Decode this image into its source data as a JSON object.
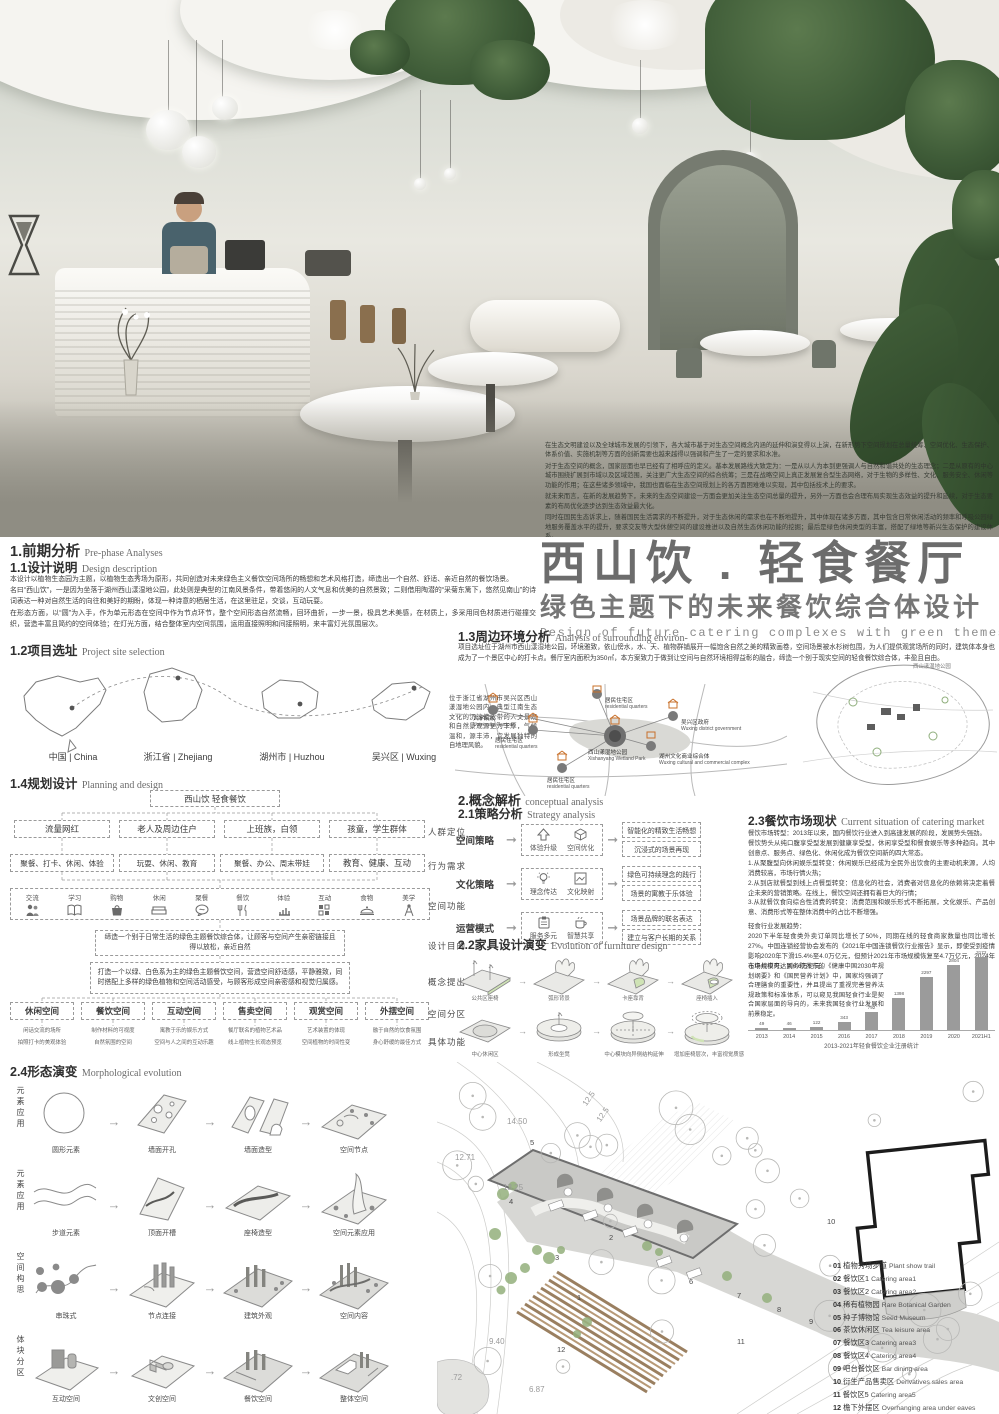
{
  "poster": {
    "title_cn": "西山饮 . 轻食餐厅",
    "subtitle_cn": "绿色主题下的未来餐饮综合体设计",
    "subtitle_en": "Design of future catering complexes with green themes"
  },
  "overlay": {
    "p1": "在生态文明建设以及全球城市发展的引领下，各大城市基于对生态空间概念内涵的延伸和演变得以上演，在新形势下空间规划在总量统筹、空间优化、生态保护、体系价值、实施机制等方面的创新需要也越来越得以强调和产生了一定的要求和水准。",
    "p2": "对于生态空间的概念，国家层面也早已经有了相呼应的定义。基本发展路线大致定为：一是从以人为本到更强调人与自然和谐共处的生态理念；二是从原有的中心城市围绕扩展到市域以及区域范围，关注更广大生态空间的综合统筹；三是在战略空间上真正发展复合型生态网络，对于生物的多样性、文化、服务安全、休闲等功能的作用；在这些诸多领域中，我国也面临在生态空间规划上的各方面困难难以实现，其中包括技术上的要求。",
    "p3": "就未来而言，在新的发展趋势下，未来的生态空间建设一方面会更加关注生态空间总量的提升，另外一方面也会合理布局实现生态效益的提升和延续，对于生态要素的布局优化逐步达到生态效益最大化。",
    "p4": "同时在国民生态诉求上，随着国民生活需求的不断提升，对于生态休闲的需求也在不断地提升，其中体现在诸多方面，其中包含日常休闲活动的频率和呼吸公园绿地服务覆盖水平的提升，要求交友等大型休憩空间的建设推进以及自然生态休闲功能的挖掘；最后是绿色休闲类型的丰富，搭配了绿地等新兴生态保护的建设体系。",
    "p5": "因此“未来化的绿色主义”也绝不再是一句空谈，而是真是极大众所需求的国家战略的未来发展趋势。"
  },
  "sec1": {
    "h_cn": "1.前期分析",
    "h_en": "Pre-phase Analyses",
    "s11_cn": "1.1设计说明",
    "s11_en": "Design description",
    "p1": "本设计以植物生态园为主题，以植物生态秀场为原形，共同创造对未来绿色主义餐饮空间场所的畅想和艺术风格打造，缔造出一个自然、舒适、亲近自然的餐饮场景。",
    "p2": "名曰“西山饮”，一是因为坐落于湖州西山漾湿地公园，此处则是典型的江南风景条件，带着悠闲的人文气息和优美的自然景致；二则借用陶潜的“采菊东篱下，悠然见南山”的诗词表达一种对自然生活的向往和美好的期盼，体现一种诗意的栖居生活，在这里驻足，交谈，互动玩耍。",
    "p3": "在形态方面，以“圆”为入手，作为单元形态在空间中作为节点环节，整个空间形态自然流畅，回环曲折，一步一景，极具艺术美感，在材质上，多采用同色材质进行碰撞交织，营造丰富且简约的空间体验；在灯光方面，结合整体室内空间氛围，运用直接照明和间接照明，来丰富灯光氛围层次。",
    "s12_cn": "1.2项目选址",
    "s12_en": "Project site selection",
    "maps": [
      "中国 | China",
      "浙江省 | Zhejiang",
      "湖州市 | Huzhou",
      "吴兴区 | Wuxing"
    ],
    "site_note": "位于浙江省湖州市吴兴区西山漾湿地公园内，典型江南生态文化的沉淀使此带的人文景观和自然景观源更为丰厚，气候温和，源丰沛，宜发展独特的自地理风貌。"
  },
  "sec13": {
    "h_cn": "1.3周边环境分析",
    "h_en": "Analysis of surrounding environ-",
    "p": "项目选址位于湖州市西山漾湿地公园，环境雅致，依山傍水，水、天、植物群铺展开一幅饱含自然之美的精致画卷，空间场景被水杉树包围，为人们提供观赏场所的同时，建筑体本身也成为了一个景区中心的打卡点。餐厅室内面积为350㎡，本方案致力于做到让空间与自然环境相得益彰的融合，缔造一个别于现实空间的轻食餐饮综合体，丰盈且自由。",
    "nodes": [
      {
        "cn": "大学院校",
        "en": "University Campus"
      },
      {
        "cn": "居民住宅区",
        "en": "residential quarters"
      },
      {
        "cn": "吴兴区政府",
        "en": "Wuxing district government"
      },
      {
        "cn": "居民住宅区",
        "en": "residential quarters"
      },
      {
        "cn": "西山漾湿地公园",
        "en": "Xishanyang Wetland Park"
      },
      {
        "cn": "湖州文化商业综合体",
        "en": "Wuxing cultural and commercial complex"
      },
      {
        "cn": "居民住宅区",
        "en": "residential quarters"
      }
    ],
    "aerial_label": "西山漾湿地公园"
  },
  "sec14": {
    "h_cn": "1.4规划设计",
    "h_en": "Planning and design",
    "root": "西山饮 轻食餐饮",
    "groups": [
      "流量网红",
      "老人及周边住户",
      "上班族，白领",
      "孩童，学生群体"
    ],
    "behaviors": [
      "聚餐、打卡、休闲、体验",
      "玩耍、休闲、教育",
      "聚餐、办公、周末带娃",
      "教育、健康、互动"
    ],
    "functions": [
      "交流",
      "学习",
      "购物",
      "休闲",
      "聚餐",
      "餐饮",
      "体验",
      "互动",
      "食物",
      "美学"
    ],
    "purpose": "缔造一个别于日常生活的绿色主题餐饮综合体，让顾客与空间产生亲密链接且得以放松，亲近自然",
    "concept": "打造一个以绿、白色系为主的绿色主题餐饮空间，营造空间舒适感，平静雅致，同时搭配上多样的绿色植物和空间活动感受，与顾客形成空间亲密感和视觉归属感。",
    "zones": [
      "休闲空间",
      "餐饮空间",
      "互动空间",
      "售卖空间",
      "观赏空间",
      "外摆空间"
    ],
    "zone_details": [
      [
        "闲话交流的场所",
        "拍照打卡的美观体验"
      ],
      [
        "制作材料的可视度",
        "自然氛围的空间"
      ],
      [
        "寓教于乐的娱乐方式",
        "空间与人之间的互动乐趣"
      ],
      [
        "餐厅联名的植物艺术品",
        "线上植物生长观态预览"
      ],
      [
        "艺术装置的体现",
        "空间植物的时间性变"
      ],
      [
        "融于自然的饮食氛围",
        "身心舒缓的最佳方式"
      ]
    ],
    "side_labels": [
      "人群定位",
      "行为需求",
      "空间功能",
      "设计目的",
      "概念提出",
      "空间分区",
      "具体功能"
    ]
  },
  "sec2": {
    "h_cn": "2.概念解析",
    "h_en": "conceptual analysis",
    "s21_cn": "2.1策略分析",
    "s21_en": "Strategy analysis",
    "rows": [
      {
        "label": "空间策略",
        "mid1": "体验升级",
        "mid2": "空间优化",
        "out1": "智能化的精致生活畅想",
        "out2": "沉浸式的场景再现"
      },
      {
        "label": "文化策略",
        "mid1": "理念传达",
        "mid2": "文化映射",
        "out1": "绿色可持续理念的践行",
        "out2": "场景的寓教于乐体验"
      },
      {
        "label": "运营模式",
        "mid1": "服务多元",
        "mid2": "智慧共享",
        "out1": "场景品牌的联名表达",
        "out2": "建立与客户长期的关系"
      }
    ],
    "s22_cn": "2.2家具设计演变",
    "s22_en": "Evolution of furniture design",
    "row1": [
      "公共区座椅",
      "弧形背景",
      "卡座靠背",
      "座椅插入"
    ],
    "row2": [
      "中心休闲区",
      "形成坐凳",
      "中心模块向异侧结构延伸",
      "增加座椅层次，丰富视觉质感"
    ],
    "s23_cn": "2.3餐饮市场现状",
    "s23_en": "Current situation of catering market",
    "p1": "餐饮市场转型：2013年以来，国内餐饮行业进入到高速发展的阶段，发展势头强劲。",
    "p2": "餐饮势头从纯口腹享受型发展到健康享受型，休闲享受型和餐食娱乐等多种趋向。其中创意点、服务点、绿色化、休闲化成为餐饮空间新的四大常态。",
    "p3": "1.从聚腹型向休闲娱乐型转变：休闲娱乐已经成为全民外出饮食的主要动机来源，人均消费较高，市场行情火热；",
    "p4": "2.从到店就餐型到线上点餐型转变：信息化的社会，消费者对信息化的依赖将决定着餐企未来的营销策略。在线上，餐饮空间还拥有着巨大的行情；",
    "p5": "3.从就餐饮食向综合性消费的转变：消费范围和娱乐形式不断拓展，文化娱乐、产品创意、消费形式等在整体消费中的占比不断增强。",
    "p6": "轻食行业发展趋势：",
    "p7": "2020下半年轻食类外卖订单同比增长了50%，同期在线的轻食商家数量也同比增长27%。中国连锁经营协会发布的《2021年中国连锁餐饮行业报告》显示，即使受到疫情影响2020年下滑15.4%至4.0万亿元，但预计2021年市场规模恢复至4.7万亿元，2024年市场规模可达到6.6万亿元。",
    "p8": "在中共中央、国务院发布的《健康中国2030年规划纲要》和《国民营养计划》中，国家均强调了合理膳食的重要性，并且提出了重视完善营养法规政策和标准体系，可以窥见我国轻食行业是契合国家层面的导向的，未来我国轻食行业发展和前景稳定。"
  },
  "sec24": {
    "h_cn": "2.4形态演变",
    "h_en": "Morphological evolution",
    "rows": [
      {
        "side": "元素应用",
        "steps": [
          "圆形元素",
          "墙面开孔",
          "墙面造型",
          "空间节点"
        ]
      },
      {
        "side": "元素应用",
        "steps": [
          "步道元素",
          "顶面开槽",
          "座椅造型",
          "空间元素应用"
        ]
      },
      {
        "side": "空间构思",
        "steps": [
          "串珠式",
          "节点连接",
          "建筑外观",
          "空间内容"
        ]
      },
      {
        "side": "体块分区",
        "steps": [
          "互动空间",
          "文创空间",
          "餐饮空间",
          "整体空间"
        ]
      }
    ]
  },
  "chart_data": {
    "type": "bar",
    "categories": [
      "2013",
      "2014",
      "2015",
      "2016",
      "2017",
      "2018",
      "2019",
      "2020",
      "2021H1"
    ],
    "values": [
      49,
      46,
      122,
      343,
      792,
      1398,
      2297,
      2804,
      3172
    ],
    "title": "2013-2021年轻食餐饮企业注册统计",
    "xlabel": "",
    "ylabel": "",
    "ylim": [
      0,
      3300
    ],
    "bar_color": "#9b9b9b",
    "grid": false,
    "legend_position": "none"
  },
  "site_plan": {
    "numbers": [
      "1",
      "2",
      "3",
      "4",
      "5",
      "6",
      "7",
      "8",
      "9",
      "10",
      "11",
      "12"
    ],
    "dims": [
      "12.71",
      "13.25",
      "14.50",
      "12.5",
      "12.5",
      "9.40",
      "6.87",
      ".72"
    ],
    "legend": [
      {
        "num": "01",
        "cn": "植物秀场步道",
        "en": "Plant show trail"
      },
      {
        "num": "02",
        "cn": "餐饮区1",
        "en": "Catering area1"
      },
      {
        "num": "03",
        "cn": "餐饮区2",
        "en": "Catering area2"
      },
      {
        "num": "04",
        "cn": "稀有植物园",
        "en": "Rare Botanical Garden"
      },
      {
        "num": "05",
        "cn": "种子博物馆",
        "en": "Seed Museum"
      },
      {
        "num": "06",
        "cn": "茶饮休闲区",
        "en": "Tea leisure area"
      },
      {
        "num": "07",
        "cn": "餐饮区3",
        "en": "Catering area3"
      },
      {
        "num": "08",
        "cn": "餐饮区4",
        "en": "Catering area4"
      },
      {
        "num": "09",
        "cn": "吧台餐饮区",
        "en": "Bar dining area"
      },
      {
        "num": "10",
        "cn": "衍生产品售卖区",
        "en": "Derivatives sales area"
      },
      {
        "num": "11",
        "cn": "餐饮区5",
        "en": "Catering area5"
      },
      {
        "num": "12",
        "cn": "檐下外摆区",
        "en": "Overhanging area under eaves"
      }
    ]
  },
  "colors": {
    "accent_green": "#cfe3b5",
    "dark_green": "#3f5c38",
    "bar": "#9b9b9b",
    "title_gray": "#6c6c6c"
  }
}
